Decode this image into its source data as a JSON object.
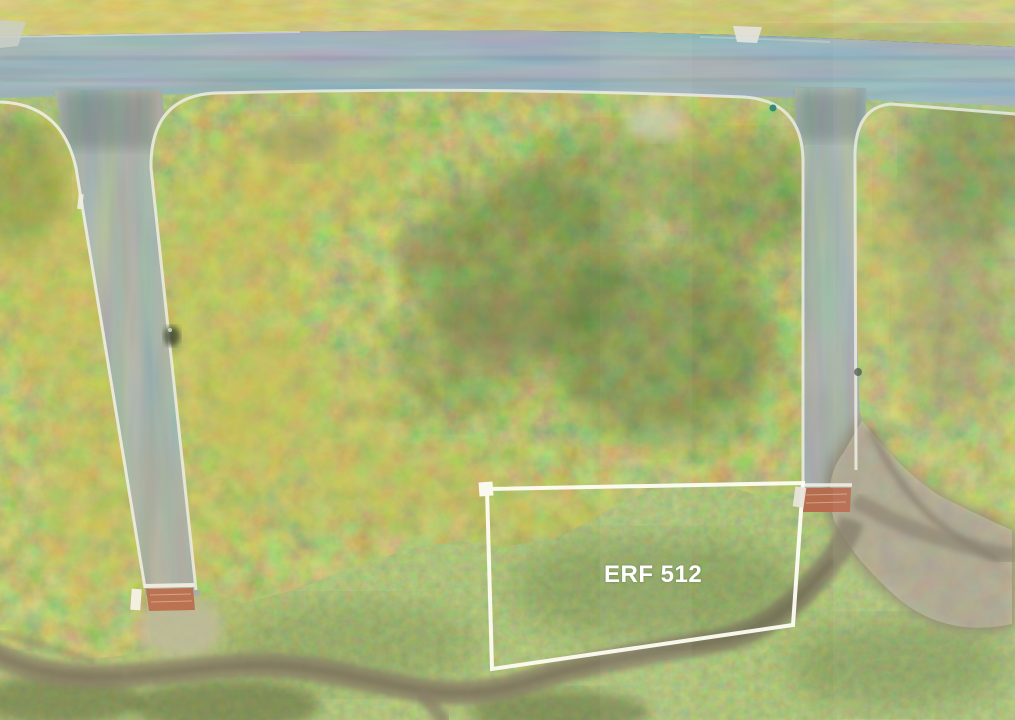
{
  "scene": {
    "type": "aerial-drone-photo-of-vacant-land",
    "plot_label": {
      "text": "ERF 512",
      "color": "#ffffff"
    },
    "palette": {
      "asphalt_main_road": "#5c6b76",
      "asphalt_side_road": "#6e766f",
      "curb_white": "#edeee6",
      "paver_red": "#b4674a",
      "shrub_olive": "#7a8038",
      "shrub_yellow": "#cdbf4e",
      "grass_green": "#5a7a3c",
      "meadow_yellow": "#b8b35a",
      "dirt_brown": "#837a66",
      "gravel_light": "#b9b5a4",
      "boundary_white": "#fdfdf8",
      "hydrant_teal": "#2a8a72"
    }
  }
}
